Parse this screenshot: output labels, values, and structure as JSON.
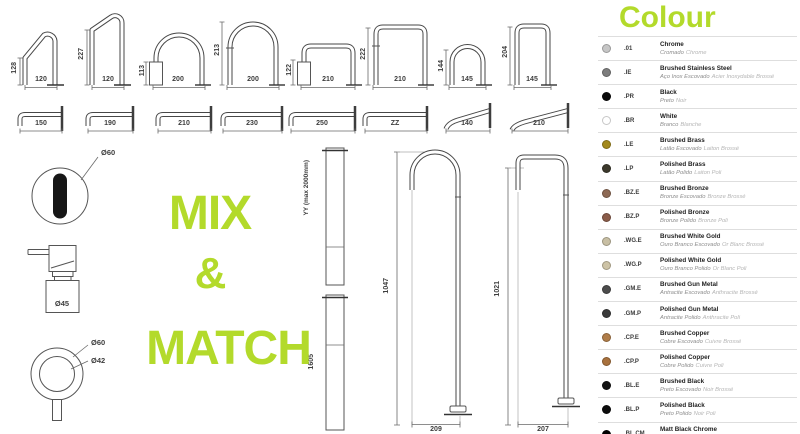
{
  "accent": "#b3da2b",
  "mix_match": {
    "line1": "MIX",
    "line2": "&",
    "line3": "MATCH"
  },
  "top_spouts": [
    {
      "height": "128",
      "width": "120"
    },
    {
      "height": "227",
      "width": "120"
    },
    {
      "height": "113",
      "width": "200"
    },
    {
      "height": "213",
      "width": "200"
    },
    {
      "height": "122",
      "width": "210"
    },
    {
      "height": "222",
      "width": "210"
    },
    {
      "height": "144",
      "width": "145"
    },
    {
      "height": "204",
      "width": "145"
    }
  ],
  "wall_spouts": [
    {
      "length": "150"
    },
    {
      "length": "190"
    },
    {
      "length": "210"
    },
    {
      "length": "230"
    },
    {
      "length": "250"
    },
    {
      "length": "ZZ"
    },
    {
      "length": "140"
    },
    {
      "length": "210"
    }
  ],
  "accessories": {
    "sensor_diameter": "Ø60",
    "dispenser_diameter": "Ø45",
    "handle_outer_diameter": "Ø60",
    "handle_inner_diameter": "Ø42"
  },
  "risers": {
    "adjustable_label": "YY (max 2000mm)",
    "fixed_height": "1605"
  },
  "floor_spouts": [
    {
      "height": "1047",
      "base": "209"
    },
    {
      "height": "1021",
      "base": "207"
    }
  ],
  "colour": {
    "title": "Colour",
    "rows": [
      {
        "code": ".01",
        "name": "Chrome",
        "pt": "Cromado",
        "fr": "Chrome",
        "dot": "#c6c6c6"
      },
      {
        "code": ".IE",
        "name": "Brushed Stainless Steel",
        "pt": "Aço Inox Escovado",
        "fr": "Acier Inoxydable Brossé",
        "dot": "#7d7d7d"
      },
      {
        "code": ".PR",
        "name": "Black",
        "pt": "Preto",
        "fr": "Noir",
        "dot": "#0a0a0a"
      },
      {
        "code": ".BR",
        "name": "White",
        "pt": "Branco",
        "fr": "Blanche",
        "dot": "#ffffff"
      },
      {
        "code": ".LE",
        "name": "Brushed Brass",
        "pt": "Latão Escovado",
        "fr": "Laiton Brossé",
        "dot": "#a3891c"
      },
      {
        "code": ".LP",
        "name": "Polished Brass",
        "pt": "Latão Polido",
        "fr": "Laiton Poli",
        "dot": "#3c392c"
      },
      {
        "code": ".BZ.E",
        "name": "Brushed Bronze",
        "pt": "Bronze Escovado",
        "fr": "Bronze Brossé",
        "dot": "#8d6954"
      },
      {
        "code": ".BZ.P",
        "name": "Polished Bronze",
        "pt": "Bronze Polido",
        "fr": "Bronze Poli",
        "dot": "#8a5c49"
      },
      {
        "code": ".WG.E",
        "name": "Brushed White Gold",
        "pt": "Ouro Branco Escovado",
        "fr": "Or Blanc Brossé",
        "dot": "#c8bfa4"
      },
      {
        "code": ".WG.P",
        "name": "Polished White Gold",
        "pt": "Ouro Branco Polido",
        "fr": "Or Blanc Poli",
        "dot": "#cdc3a6"
      },
      {
        "code": ".GM.E",
        "name": "Brushed Gun Metal",
        "pt": "Antracite Escovado",
        "fr": "Anthracite Brossé",
        "dot": "#4c4c4c"
      },
      {
        "code": ".GM.P",
        "name": "Polished Gun Metal",
        "pt": "Antracite Polido",
        "fr": "Anthracite Poli",
        "dot": "#3b3b3b"
      },
      {
        "code": ".CP.E",
        "name": "Brushed Copper",
        "pt": "Cobre Escovado",
        "fr": "Cuivre Brossé",
        "dot": "#b07d49"
      },
      {
        "code": ".CP.P",
        "name": "Polished Copper",
        "pt": "Cobre Polido",
        "fr": "Cuivre Poli",
        "dot": "#a8713d"
      },
      {
        "code": ".BL.E",
        "name": "Brushed Black",
        "pt": "Preto Escovado",
        "fr": "Noir Brossé",
        "dot": "#141414"
      },
      {
        "code": ".BL.P",
        "name": "Polished Black",
        "pt": "Preto Polido",
        "fr": "Noir Poli",
        "dot": "#0d0d0d"
      },
      {
        "code": ".BL.CM",
        "name": "Matt Black Chrome",
        "pt": "Preto Cromado Mate",
        "fr": "Chrome Noir Mat",
        "dot": "#000000"
      }
    ]
  }
}
